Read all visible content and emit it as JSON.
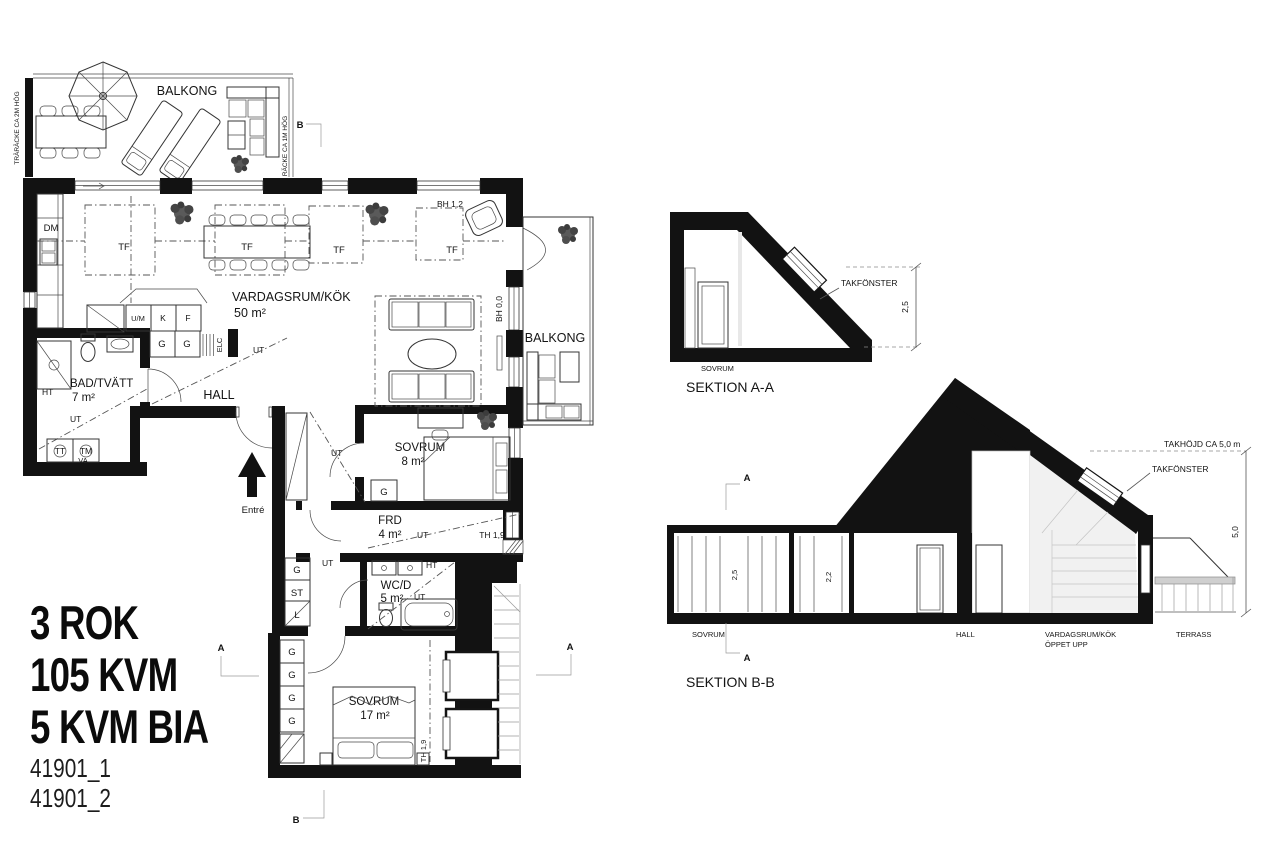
{
  "info": {
    "line1": "3 ROK",
    "line2": "105 KVM",
    "line3": "5 KVM BIA",
    "id1": "41901_1",
    "id2": "41901_2"
  },
  "plan": {
    "balcony_top_label": "BALKONG",
    "balcony_right_label": "BALKONG",
    "railing_left": "TRÄRÄCKE CA 2M HÖG",
    "railing_right": "RÄCKE CA 1M HÖG",
    "living_name": "VARDAGSRUM/KÖK",
    "living_area": "50 m²",
    "bath_name": "BAD/TVÄTT",
    "bath_area": "7 m²",
    "hall_label": "HALL",
    "entry_label": "Entré",
    "bed8_name": "SOVRUM",
    "bed8_area": "8 m²",
    "frd_name": "FRD",
    "frd_area": "4 m²",
    "wc_name": "WC/D",
    "wc_area": "5 m²",
    "bed17_name": "SOVRUM",
    "bed17_area": "17 m²",
    "abbr": {
      "dm": "DM",
      "tf": "TF",
      "um": "U/M",
      "k": "K",
      "f": "F",
      "g": "G",
      "elc": "ELC",
      "ht": "HT",
      "ut": "UT",
      "tt": "TT",
      "tm": "TM",
      "va": "VA",
      "st": "ST",
      "l": "L"
    },
    "dims": {
      "bh12": "BH 1,2",
      "bh00": "BH 0,0",
      "th19": "TH 1,9"
    },
    "markers": {
      "a": "A",
      "b": "B"
    }
  },
  "section_a": {
    "title": "SEKTION A-A",
    "room": "SOVRUM",
    "skylight_label": "TAKFÖNSTER",
    "height": "2,5"
  },
  "section_b": {
    "title": "SEKTION B-B",
    "roof_height_label": "TAKHÖJD CA 5,0 m",
    "skylight_label": "TAKFÖNSTER",
    "dim_bed": "2,5",
    "dim_hall": "2,2",
    "dim_right": "5,0",
    "room_bed": "SOVRUM",
    "room_hall": "HALL",
    "room_living": "VARDAGSRUM/KÖK",
    "room_living2": "ÖPPET UPP",
    "room_terrace": "TERRASS",
    "marker": "A"
  }
}
